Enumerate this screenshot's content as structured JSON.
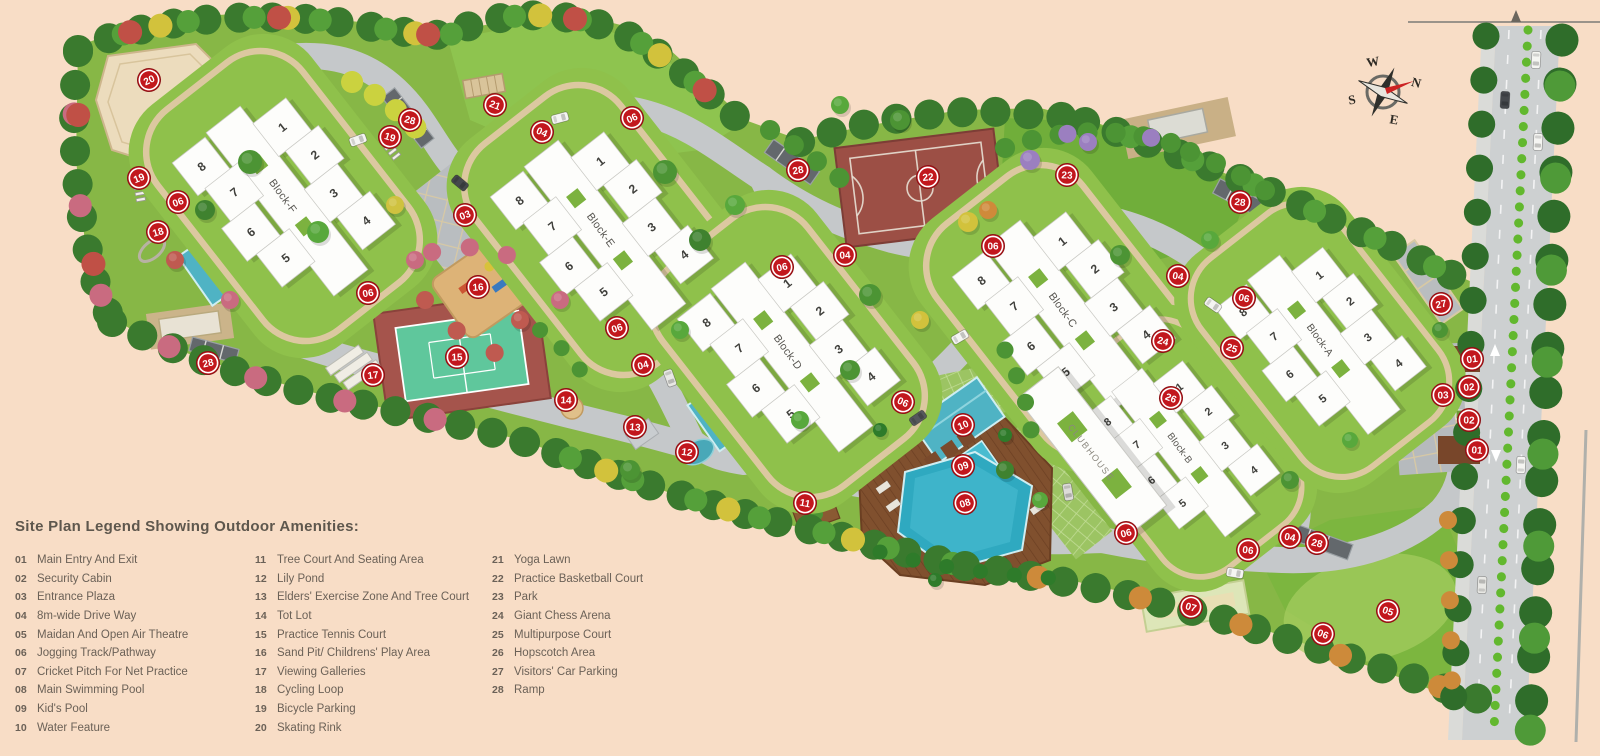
{
  "colors": {
    "background": "#f8ddc6",
    "site_green": "#87b746",
    "pod_green": "#8fc14b",
    "road_gray": "#c5c8ca",
    "marker_red": "#c2171d",
    "pool_teal": "#2fa9c0",
    "deck_brown": "#80502e",
    "court_maroon": "#9c4f45",
    "tennis_green": "#5fc79c",
    "legend_text": "#6b6157"
  },
  "legend": {
    "title": "Site Plan Legend Showing Outdoor Amenities:",
    "columns": [
      [
        {
          "num": "01",
          "label": "Main Entry And Exit"
        },
        {
          "num": "02",
          "label": "Security Cabin"
        },
        {
          "num": "03",
          "label": "Entrance Plaza"
        },
        {
          "num": "04",
          "label": "8m-wide Drive Way"
        },
        {
          "num": "05",
          "label": "Maidan And Open Air Theatre"
        },
        {
          "num": "06",
          "label": "Jogging Track/Pathway"
        },
        {
          "num": "07",
          "label": "Cricket Pitch For Net Practice"
        },
        {
          "num": "08",
          "label": "Main Swimming Pool"
        },
        {
          "num": "09",
          "label": "Kid's Pool"
        },
        {
          "num": "10",
          "label": "Water Feature"
        }
      ],
      [
        {
          "num": "11",
          "label": "Tree Court And Seating Area"
        },
        {
          "num": "12",
          "label": "Lily Pond"
        },
        {
          "num": "13",
          "label": "Elders' Exercise Zone And Tree Court"
        },
        {
          "num": "14",
          "label": "Tot Lot"
        },
        {
          "num": "15",
          "label": "Practice Tennis Court"
        },
        {
          "num": "16",
          "label": "Sand Pit/ Childrens' Play Area"
        },
        {
          "num": "17",
          "label": "Viewing Galleries"
        },
        {
          "num": "18",
          "label": "Cycling Loop"
        },
        {
          "num": "19",
          "label": "Bicycle Parking"
        },
        {
          "num": "20",
          "label": "Skating Rink"
        }
      ],
      [
        {
          "num": "21",
          "label": "Yoga Lawn"
        },
        {
          "num": "22",
          "label": "Practice Basketball Court"
        },
        {
          "num": "23",
          "label": "Park"
        },
        {
          "num": "24",
          "label": "Giant Chess Arena"
        },
        {
          "num": "25",
          "label": "Multipurpose Court"
        },
        {
          "num": "26",
          "label": "Hopscotch Area"
        },
        {
          "num": "27",
          "label": "Visitors' Car Parking"
        },
        {
          "num": "28",
          "label": "Ramp"
        }
      ]
    ]
  },
  "compass": {
    "n": "N",
    "e": "E",
    "s": "S",
    "w": "W"
  },
  "clubhouse": {
    "label": "CLUBHOUSE"
  },
  "blocks": [
    {
      "label": "Block-F",
      "x": 283,
      "y": 196,
      "rot": -38,
      "s": 0.72
    },
    {
      "label": "Block-E",
      "x": 601,
      "y": 230,
      "rot": -38,
      "s": 0.72
    },
    {
      "label": "Block-D",
      "x": 788,
      "y": 352,
      "rot": -38,
      "s": 0.72
    },
    {
      "label": "Block-C",
      "x": 1063,
      "y": 310,
      "rot": -38,
      "s": 0.72
    },
    {
      "label": "Block-B",
      "x": 1180,
      "y": 448,
      "rot": -38,
      "s": 0.64
    },
    {
      "label": "Block-A",
      "x": 1320,
      "y": 340,
      "rot": -38,
      "s": 0.68
    }
  ],
  "block_wings": [
    "8",
    "7",
    "6",
    "5",
    "1",
    "2",
    "3",
    "4"
  ],
  "markers": [
    {
      "n": "20",
      "x": 149,
      "y": 80
    },
    {
      "n": "19",
      "x": 139,
      "y": 178
    },
    {
      "n": "06",
      "x": 178,
      "y": 202
    },
    {
      "n": "18",
      "x": 158,
      "y": 232
    },
    {
      "n": "28",
      "x": 208,
      "y": 363
    },
    {
      "n": "06",
      "x": 368,
      "y": 293
    },
    {
      "n": "17",
      "x": 373,
      "y": 375
    },
    {
      "n": "16",
      "x": 478,
      "y": 287
    },
    {
      "n": "15",
      "x": 457,
      "y": 357
    },
    {
      "n": "14",
      "x": 566,
      "y": 400
    },
    {
      "n": "13",
      "x": 635,
      "y": 427
    },
    {
      "n": "12",
      "x": 687,
      "y": 452
    },
    {
      "n": "11",
      "x": 805,
      "y": 503
    },
    {
      "n": "28",
      "x": 410,
      "y": 120
    },
    {
      "n": "19",
      "x": 390,
      "y": 137
    },
    {
      "n": "21",
      "x": 495,
      "y": 105
    },
    {
      "n": "04",
      "x": 542,
      "y": 132
    },
    {
      "n": "06",
      "x": 632,
      "y": 118
    },
    {
      "n": "03",
      "x": 465,
      "y": 215
    },
    {
      "n": "06",
      "x": 617,
      "y": 328
    },
    {
      "n": "04",
      "x": 643,
      "y": 365
    },
    {
      "n": "06",
      "x": 782,
      "y": 267
    },
    {
      "n": "28",
      "x": 798,
      "y": 170
    },
    {
      "n": "22",
      "x": 928,
      "y": 177
    },
    {
      "n": "04",
      "x": 845,
      "y": 255
    },
    {
      "n": "06",
      "x": 993,
      "y": 246
    },
    {
      "n": "23",
      "x": 1067,
      "y": 175
    },
    {
      "n": "28",
      "x": 1240,
      "y": 202
    },
    {
      "n": "04",
      "x": 1178,
      "y": 276
    },
    {
      "n": "06",
      "x": 1244,
      "y": 298
    },
    {
      "n": "24",
      "x": 1163,
      "y": 341
    },
    {
      "n": "25",
      "x": 1232,
      "y": 348
    },
    {
      "n": "26",
      "x": 1171,
      "y": 398
    },
    {
      "n": "06",
      "x": 903,
      "y": 402
    },
    {
      "n": "10",
      "x": 963,
      "y": 425
    },
    {
      "n": "09",
      "x": 963,
      "y": 466
    },
    {
      "n": "08",
      "x": 965,
      "y": 503
    },
    {
      "n": "06",
      "x": 1126,
      "y": 533
    },
    {
      "n": "27",
      "x": 1441,
      "y": 304
    },
    {
      "n": "01",
      "x": 1472,
      "y": 359
    },
    {
      "n": "02",
      "x": 1469,
      "y": 387
    },
    {
      "n": "03",
      "x": 1443,
      "y": 395
    },
    {
      "n": "02",
      "x": 1469,
      "y": 420
    },
    {
      "n": "01",
      "x": 1477,
      "y": 450
    },
    {
      "n": "06",
      "x": 1248,
      "y": 550
    },
    {
      "n": "04",
      "x": 1290,
      "y": 537
    },
    {
      "n": "28",
      "x": 1317,
      "y": 543
    },
    {
      "n": "07",
      "x": 1191,
      "y": 607
    },
    {
      "n": "05",
      "x": 1388,
      "y": 611
    },
    {
      "n": "06",
      "x": 1323,
      "y": 634
    }
  ]
}
